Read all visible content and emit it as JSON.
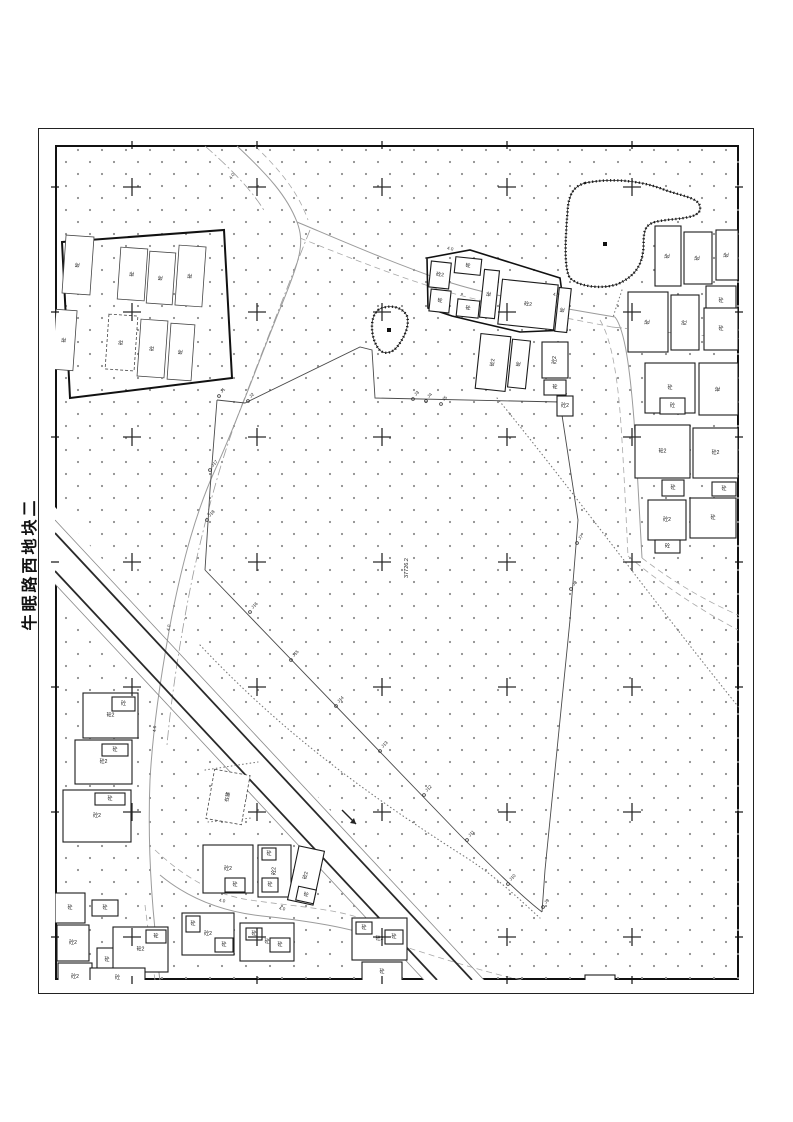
{
  "page": {
    "width": 793,
    "height": 1122,
    "background": "#ffffff",
    "title": "牛眠路西地块二"
  },
  "frame": {
    "outer": {
      "x": 38,
      "y": 128,
      "w": 716,
      "h": 866
    },
    "inner": {
      "x": 55,
      "y": 145,
      "w": 684,
      "h": 835
    },
    "tick_len": 8
  },
  "colors": {
    "ink": "#1c1c1c",
    "road": "#9b9b9b",
    "road_dash": "#a8a8a8",
    "veg_dot": "#8f8f8f",
    "canal": "#2a2a2a",
    "canal_thin": "#8a8a8a",
    "boundary": "#4a4a4a",
    "cross": "#2b2b2b"
  },
  "map": {
    "area_label": {
      "x": 408,
      "y": 568,
      "rot": -90,
      "text": "37726.2"
    },
    "grid": {
      "cols": [
        132,
        257,
        382,
        507,
        632
      ],
      "rows": [
        187,
        312,
        437,
        562,
        687,
        812,
        937
      ],
      "arm": 9
    },
    "legend": {
      "concrete": "砼",
      "concrete_2story": "砼2",
      "under_construction": "在建"
    },
    "compounds": [
      {
        "name": "factory-wall",
        "points": "62,242 224,230 232,378 70,398",
        "w": 2
      },
      {
        "name": "cluster-wall",
        "points": "427,258 470,250 560,278 567,330 520,332 477,322 452,316 428,308",
        "w": 1.6
      }
    ],
    "ponds": [
      {
        "name": "pond-large",
        "path": "M585,183 C610,178 640,180 665,190 C685,197 702,198 700,210 C697,220 670,218 655,222 C640,226 645,240 643,252 C641,266 635,276 618,284 C600,290 578,286 570,278 C563,268 566,230 568,206 C570,192 575,186 585,183 Z",
        "dot": [
          605,
          244
        ]
      },
      {
        "name": "pond-small",
        "path": "M378,310 C388,304 402,306 407,316 C410,326 404,338 397,347 C391,354 383,355 378,348 C371,338 369,318 378,310 Z",
        "dot": [
          389,
          330
        ]
      }
    ],
    "canal": {
      "band": "55,507 484,980 424,980 55,584",
      "lines": [
        {
          "x1": 55,
          "y1": 520,
          "x2": 484,
          "y2": 980,
          "cls": "thin"
        },
        {
          "x1": 55,
          "y1": 533,
          "x2": 472,
          "y2": 980,
          "cls": "dark"
        },
        {
          "x1": 55,
          "y1": 571,
          "x2": 437,
          "y2": 980,
          "cls": "dark"
        },
        {
          "x1": 55,
          "y1": 584,
          "x2": 424,
          "y2": 980,
          "cls": "thin"
        }
      ],
      "arrow": {
        "x1": 342,
        "y1": 810,
        "x2": 356,
        "y2": 824
      }
    },
    "roads": [
      {
        "d": "M237,146 C268,175 287,196 297,222 C305,243 300,260 282,304 C262,352 238,420 215,470 C196,512 183,560 172,615 C162,668 153,725 150,780 C148,830 150,880 155,930 C157,955 158,968 160,980",
        "style": "solid"
      },
      {
        "d": "M255,146 C280,170 298,192 308,220",
        "style": "dashed"
      },
      {
        "d": "M297,222 C340,240 390,262 445,281 C495,297 550,306 615,317",
        "style": "solid"
      },
      {
        "d": "M300,238 C345,256 395,276 448,292 C498,306 552,315 612,327",
        "style": "dashed"
      },
      {
        "d": "M615,317 C625,330 630,370 634,420 C637,465 640,520 642,558",
        "style": "solid"
      },
      {
        "d": "M600,320 C612,340 618,380 621,425 C624,470 626,515 628,556",
        "style": "dashed"
      },
      {
        "d": "M642,558 C668,578 702,600 745,618",
        "style": "dashed"
      },
      {
        "d": "M628,556 C656,580 695,607 738,630",
        "style": "dashed"
      },
      {
        "d": "M155,850 C185,878 215,895 250,900 C290,906 330,908 360,918",
        "style": "dashed"
      },
      {
        "d": "M160,875 C190,900 225,912 262,916 C300,920 335,925 362,933",
        "style": "solid"
      },
      {
        "d": "M362,933 C400,945 450,962 500,975 C520,980 540,983 556,984",
        "style": "dashed"
      },
      {
        "d": "M145,905 C148,930 152,958 155,980",
        "style": "dashed"
      },
      {
        "d": "M310,230 C290,280 265,345 240,410 C220,462 205,520 193,575 C182,628 172,690 167,745",
        "style": "dashdot"
      },
      {
        "d": "M205,146 C230,168 252,190 265,212",
        "style": "dashdot"
      },
      {
        "d": "M612,327 C680,334 720,337 745,339",
        "style": "dashdot"
      }
    ],
    "dotted_lines": [
      {
        "d": "M497,398 C580,500 660,610 745,715"
      },
      {
        "d": "M200,645 C280,730 360,790 470,860 C500,880 520,900 540,918"
      },
      {
        "d": "M205,770 L258,762"
      },
      {
        "d": "M208,822 L252,818"
      },
      {
        "d": "M622,290 C618,302 615,310 613,318"
      }
    ],
    "boundary": {
      "paths": [
        {
          "d": "M217,400 L245,403 L360,347 L372,350 L375,398 L560,402"
        },
        {
          "d": "M560,402 L578,520 L570,620 L556,760 L545,870 L542,912"
        },
        {
          "d": "M205,570 C300,668 380,752 460,835 C490,865 520,895 542,912"
        },
        {
          "d": "M205,570 L210,490 L217,400"
        }
      ],
      "points": [
        {
          "x": 219,
          "y": 396,
          "label": "J1"
        },
        {
          "x": 248,
          "y": 401,
          "label": "J2"
        },
        {
          "x": 413,
          "y": 399,
          "label": "J3"
        },
        {
          "x": 426,
          "y": 401,
          "label": "J4"
        },
        {
          "x": 441,
          "y": 404,
          "label": "J5"
        },
        {
          "x": 561,
          "y": 400,
          "label": "J6"
        },
        {
          "x": 577,
          "y": 543,
          "label": "J7"
        },
        {
          "x": 571,
          "y": 589,
          "label": "J8"
        },
        {
          "x": 543,
          "y": 907,
          "label": "J9"
        },
        {
          "x": 508,
          "y": 884,
          "label": "J10"
        },
        {
          "x": 467,
          "y": 840,
          "label": "J11"
        },
        {
          "x": 424,
          "y": 795,
          "label": "J12"
        },
        {
          "x": 380,
          "y": 751,
          "label": "J13"
        },
        {
          "x": 336,
          "y": 706,
          "label": "J14"
        },
        {
          "x": 291,
          "y": 660,
          "label": "J15"
        },
        {
          "x": 250,
          "y": 612,
          "label": "J16"
        },
        {
          "x": 210,
          "y": 470,
          "label": "J17"
        },
        {
          "x": 207,
          "y": 520,
          "label": "J18"
        }
      ],
      "label_rot": -46
    },
    "road_labels": [
      {
        "x": 233,
        "y": 177,
        "rot": -55,
        "text": "4.0"
      },
      {
        "x": 450,
        "y": 250,
        "rot": 12,
        "text": "4.0"
      },
      {
        "x": 556,
        "y": 296,
        "rot": 8,
        "text": "4.0"
      },
      {
        "x": 170,
        "y": 628,
        "rot": -78,
        "text": "4.0"
      },
      {
        "x": 156,
        "y": 729,
        "rot": -85,
        "text": "4.0"
      },
      {
        "x": 222,
        "y": 902,
        "rot": 8,
        "text": "4.0"
      },
      {
        "x": 282,
        "y": 910,
        "rot": 8,
        "text": "4.0"
      }
    ],
    "buildings": [
      {
        "x": 64,
        "y": 236,
        "w": 28,
        "h": 58,
        "rot": 4,
        "label": "砼",
        "thin": true
      },
      {
        "x": 119,
        "y": 248,
        "w": 27,
        "h": 52,
        "rot": 4,
        "label": "砼",
        "thin": true
      },
      {
        "x": 148,
        "y": 252,
        "w": 26,
        "h": 52,
        "rot": 4,
        "label": "砼",
        "thin": true
      },
      {
        "x": 177,
        "y": 246,
        "w": 27,
        "h": 60,
        "rot": 4,
        "label": "砼",
        "thin": true
      },
      {
        "x": 54,
        "y": 310,
        "w": 21,
        "h": 60,
        "rot": 4,
        "label": "砼",
        "thin": true
      },
      {
        "x": 107,
        "y": 315,
        "w": 29,
        "h": 55,
        "rot": 4,
        "label": "砼",
        "thin": true,
        "dashed": true
      },
      {
        "x": 139,
        "y": 320,
        "w": 27,
        "h": 57,
        "rot": 4,
        "label": "砼",
        "thin": true
      },
      {
        "x": 169,
        "y": 324,
        "w": 24,
        "h": 56,
        "rot": 4,
        "label": "砼",
        "thin": true
      },
      {
        "x": 430,
        "y": 262,
        "w": 20,
        "h": 26,
        "rot": 6,
        "label": "砼2"
      },
      {
        "x": 430,
        "y": 290,
        "w": 20,
        "h": 22,
        "rot": 6,
        "label": "砼"
      },
      {
        "x": 455,
        "y": 258,
        "w": 26,
        "h": 16,
        "rot": 6,
        "label": "砼"
      },
      {
        "x": 457,
        "y": 300,
        "w": 22,
        "h": 17,
        "rot": 6,
        "label": "砼"
      },
      {
        "x": 482,
        "y": 270,
        "w": 15,
        "h": 48,
        "rot": 6,
        "label": "砼"
      },
      {
        "x": 500,
        "y": 282,
        "w": 56,
        "h": 45,
        "rot": 6,
        "label": "砼2"
      },
      {
        "x": 557,
        "y": 288,
        "w": 12,
        "h": 44,
        "rot": 6,
        "label": "砼"
      },
      {
        "x": 478,
        "y": 335,
        "w": 30,
        "h": 55,
        "rot": 6,
        "label": "砼2"
      },
      {
        "x": 510,
        "y": 340,
        "w": 18,
        "h": 48,
        "rot": 6,
        "label": "砼"
      },
      {
        "x": 542,
        "y": 342,
        "w": 26,
        "h": 36,
        "rot": 0,
        "label": "砼2"
      },
      {
        "x": 544,
        "y": 380,
        "w": 22,
        "h": 15,
        "rot": 0,
        "label": "砼"
      },
      {
        "x": 557,
        "y": 396,
        "w": 16,
        "h": 20,
        "rot": 0,
        "label": "砼2"
      },
      {
        "x": 655,
        "y": 226,
        "w": 26,
        "h": 60,
        "rot": 0,
        "label": "砼"
      },
      {
        "x": 684,
        "y": 232,
        "w": 28,
        "h": 52,
        "rot": 0,
        "label": "砼"
      },
      {
        "x": 716,
        "y": 230,
        "w": 22,
        "h": 50,
        "rot": 0,
        "label": "砼"
      },
      {
        "x": 706,
        "y": 286,
        "w": 30,
        "h": 30,
        "rot": 0,
        "label": "砼"
      },
      {
        "x": 628,
        "y": 292,
        "w": 40,
        "h": 60,
        "rot": 0,
        "label": "砼"
      },
      {
        "x": 671,
        "y": 295,
        "w": 28,
        "h": 55,
        "rot": 0,
        "label": "砼"
      },
      {
        "x": 704,
        "y": 308,
        "w": 34,
        "h": 42,
        "rot": 0,
        "label": "砼"
      },
      {
        "x": 645,
        "y": 363,
        "w": 50,
        "h": 50,
        "rot": 0,
        "label": "砼"
      },
      {
        "x": 699,
        "y": 363,
        "w": 39,
        "h": 52,
        "rot": 0,
        "label": "砼"
      },
      {
        "x": 660,
        "y": 398,
        "w": 25,
        "h": 16,
        "rot": 0,
        "label": "砼"
      },
      {
        "x": 635,
        "y": 425,
        "w": 55,
        "h": 53,
        "rot": 0,
        "label": "砼2"
      },
      {
        "x": 693,
        "y": 428,
        "w": 45,
        "h": 50,
        "rot": 0,
        "label": "砼2"
      },
      {
        "x": 662,
        "y": 480,
        "w": 22,
        "h": 16,
        "rot": 0,
        "label": "砼"
      },
      {
        "x": 712,
        "y": 482,
        "w": 24,
        "h": 14,
        "rot": 0,
        "label": "砼"
      },
      {
        "x": 648,
        "y": 500,
        "w": 38,
        "h": 40,
        "rot": 0,
        "label": "砼2"
      },
      {
        "x": 690,
        "y": 498,
        "w": 46,
        "h": 40,
        "rot": 0,
        "label": "砼"
      },
      {
        "x": 655,
        "y": 540,
        "w": 25,
        "h": 13,
        "rot": 0,
        "label": "砼"
      },
      {
        "x": 83,
        "y": 693,
        "w": 55,
        "h": 45,
        "rot": 0,
        "label": "砼2"
      },
      {
        "x": 112,
        "y": 697,
        "w": 23,
        "h": 14,
        "rot": 0,
        "label": "砼"
      },
      {
        "x": 75,
        "y": 740,
        "w": 57,
        "h": 44,
        "rot": 0,
        "label": "砼2"
      },
      {
        "x": 102,
        "y": 744,
        "w": 26,
        "h": 12,
        "rot": 0,
        "label": "砼"
      },
      {
        "x": 63,
        "y": 790,
        "w": 68,
        "h": 52,
        "rot": 0,
        "label": "砼2"
      },
      {
        "x": 95,
        "y": 793,
        "w": 30,
        "h": 12,
        "rot": 0,
        "label": "砼"
      },
      {
        "x": 210,
        "y": 772,
        "w": 36,
        "h": 50,
        "rot": 10,
        "label": "在建",
        "dashed": true,
        "thin": true
      },
      {
        "x": 55,
        "y": 893,
        "w": 30,
        "h": 30,
        "rot": 0,
        "label": "砼"
      },
      {
        "x": 57,
        "y": 925,
        "w": 32,
        "h": 36,
        "rot": 0,
        "label": "砼2"
      },
      {
        "x": 92,
        "y": 900,
        "w": 26,
        "h": 16,
        "rot": 0,
        "label": "砼"
      },
      {
        "x": 58,
        "y": 963,
        "w": 34,
        "h": 28,
        "rot": 0,
        "label": "砼2"
      },
      {
        "x": 97,
        "y": 948,
        "w": 20,
        "h": 24,
        "rot": 0,
        "label": "砼"
      },
      {
        "x": 113,
        "y": 927,
        "w": 55,
        "h": 45,
        "rot": 0,
        "label": "砼2"
      },
      {
        "x": 146,
        "y": 930,
        "w": 20,
        "h": 13,
        "rot": 0,
        "label": "砼"
      },
      {
        "x": 90,
        "y": 968,
        "w": 55,
        "h": 20,
        "rot": 0,
        "label": "砼"
      },
      {
        "x": 203,
        "y": 845,
        "w": 50,
        "h": 48,
        "rot": 0,
        "label": "砼2"
      },
      {
        "x": 225,
        "y": 878,
        "w": 20,
        "h": 14,
        "rot": 0,
        "label": "砼"
      },
      {
        "x": 258,
        "y": 845,
        "w": 33,
        "h": 52,
        "rot": 0,
        "label": "砼2"
      },
      {
        "x": 262,
        "y": 848,
        "w": 14,
        "h": 12,
        "rot": 0,
        "label": "砼"
      },
      {
        "x": 262,
        "y": 878,
        "w": 16,
        "h": 14,
        "rot": 0,
        "label": "砼"
      },
      {
        "x": 293,
        "y": 848,
        "w": 26,
        "h": 55,
        "rot": 12,
        "label": "砼2"
      },
      {
        "x": 297,
        "y": 888,
        "w": 18,
        "h": 14,
        "rot": 12,
        "label": "砼"
      },
      {
        "x": 182,
        "y": 913,
        "w": 52,
        "h": 42,
        "rot": 0,
        "label": "砼2"
      },
      {
        "x": 186,
        "y": 916,
        "w": 14,
        "h": 16,
        "rot": 0,
        "label": "砼"
      },
      {
        "x": 215,
        "y": 938,
        "w": 18,
        "h": 14,
        "rot": 0,
        "label": "砼"
      },
      {
        "x": 240,
        "y": 923,
        "w": 54,
        "h": 38,
        "rot": 0,
        "label": "砼"
      },
      {
        "x": 246,
        "y": 928,
        "w": 16,
        "h": 12,
        "rot": 0,
        "label": "砼"
      },
      {
        "x": 270,
        "y": 938,
        "w": 20,
        "h": 14,
        "rot": 0,
        "label": "砼"
      },
      {
        "x": 352,
        "y": 918,
        "w": 55,
        "h": 42,
        "rot": 0,
        "label": "砼2"
      },
      {
        "x": 356,
        "y": 922,
        "w": 16,
        "h": 12,
        "rot": 0,
        "label": "砼"
      },
      {
        "x": 385,
        "y": 930,
        "w": 18,
        "h": 14,
        "rot": 0,
        "label": "砼"
      },
      {
        "x": 362,
        "y": 962,
        "w": 40,
        "h": 20,
        "rot": 0,
        "label": "砼"
      },
      {
        "x": 540,
        "y": 982,
        "w": 42,
        "h": 16,
        "rot": 0,
        "label": "砼"
      },
      {
        "x": 585,
        "y": 975,
        "w": 30,
        "h": 20,
        "rot": 0,
        "label": "砼"
      }
    ]
  }
}
